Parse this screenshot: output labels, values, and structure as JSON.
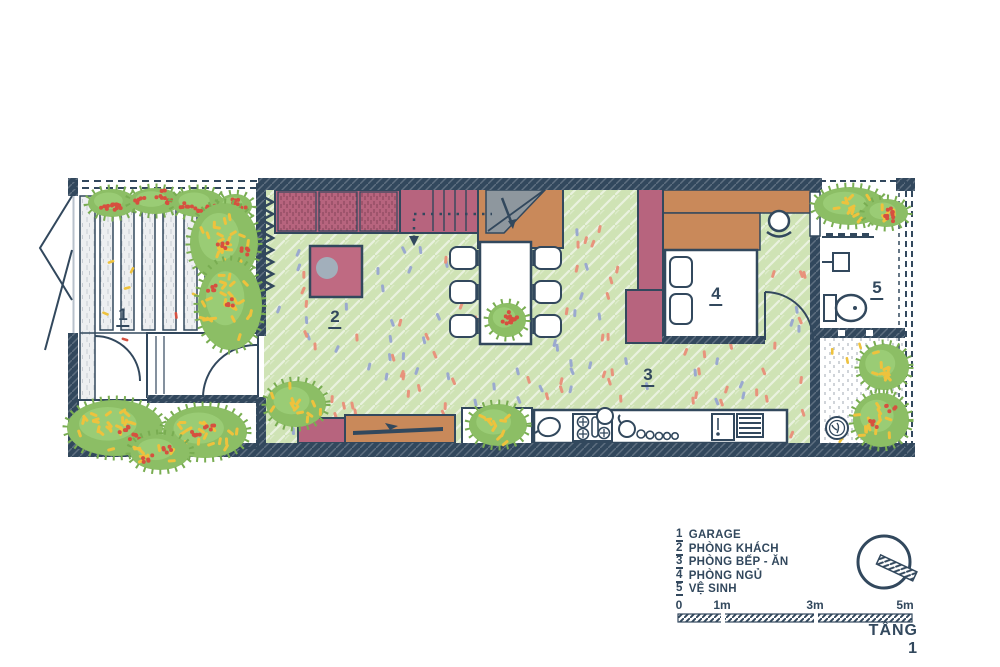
{
  "colors": {
    "wall_navy": "#32485d",
    "floor_green": "#cfe3b5",
    "plant_green": "#8cbe65",
    "accent_maroon": "#b7647e",
    "accent_orange": "#c9895a",
    "stair_gray": "#8e979e",
    "flower_yellow": "#eec23d",
    "flower_red": "#d6503f",
    "confetti_salmon": "#e8937c",
    "confetti_blue": "#9aa9cf"
  },
  "rooms": [
    {
      "number": "1",
      "name": "GARAGE"
    },
    {
      "number": "2",
      "name": "PHÒNG KHÁCH"
    },
    {
      "number": "3",
      "name": "PHÒNG BẾP - ĂN"
    },
    {
      "number": "4",
      "name": "PHÒNG NGỦ"
    },
    {
      "number": "5",
      "name": "VỆ SINH"
    }
  ],
  "scale_bar": {
    "ticks": [
      "0",
      "1m",
      "3m",
      "5m"
    ]
  },
  "floor_label": "TẦNG 1"
}
